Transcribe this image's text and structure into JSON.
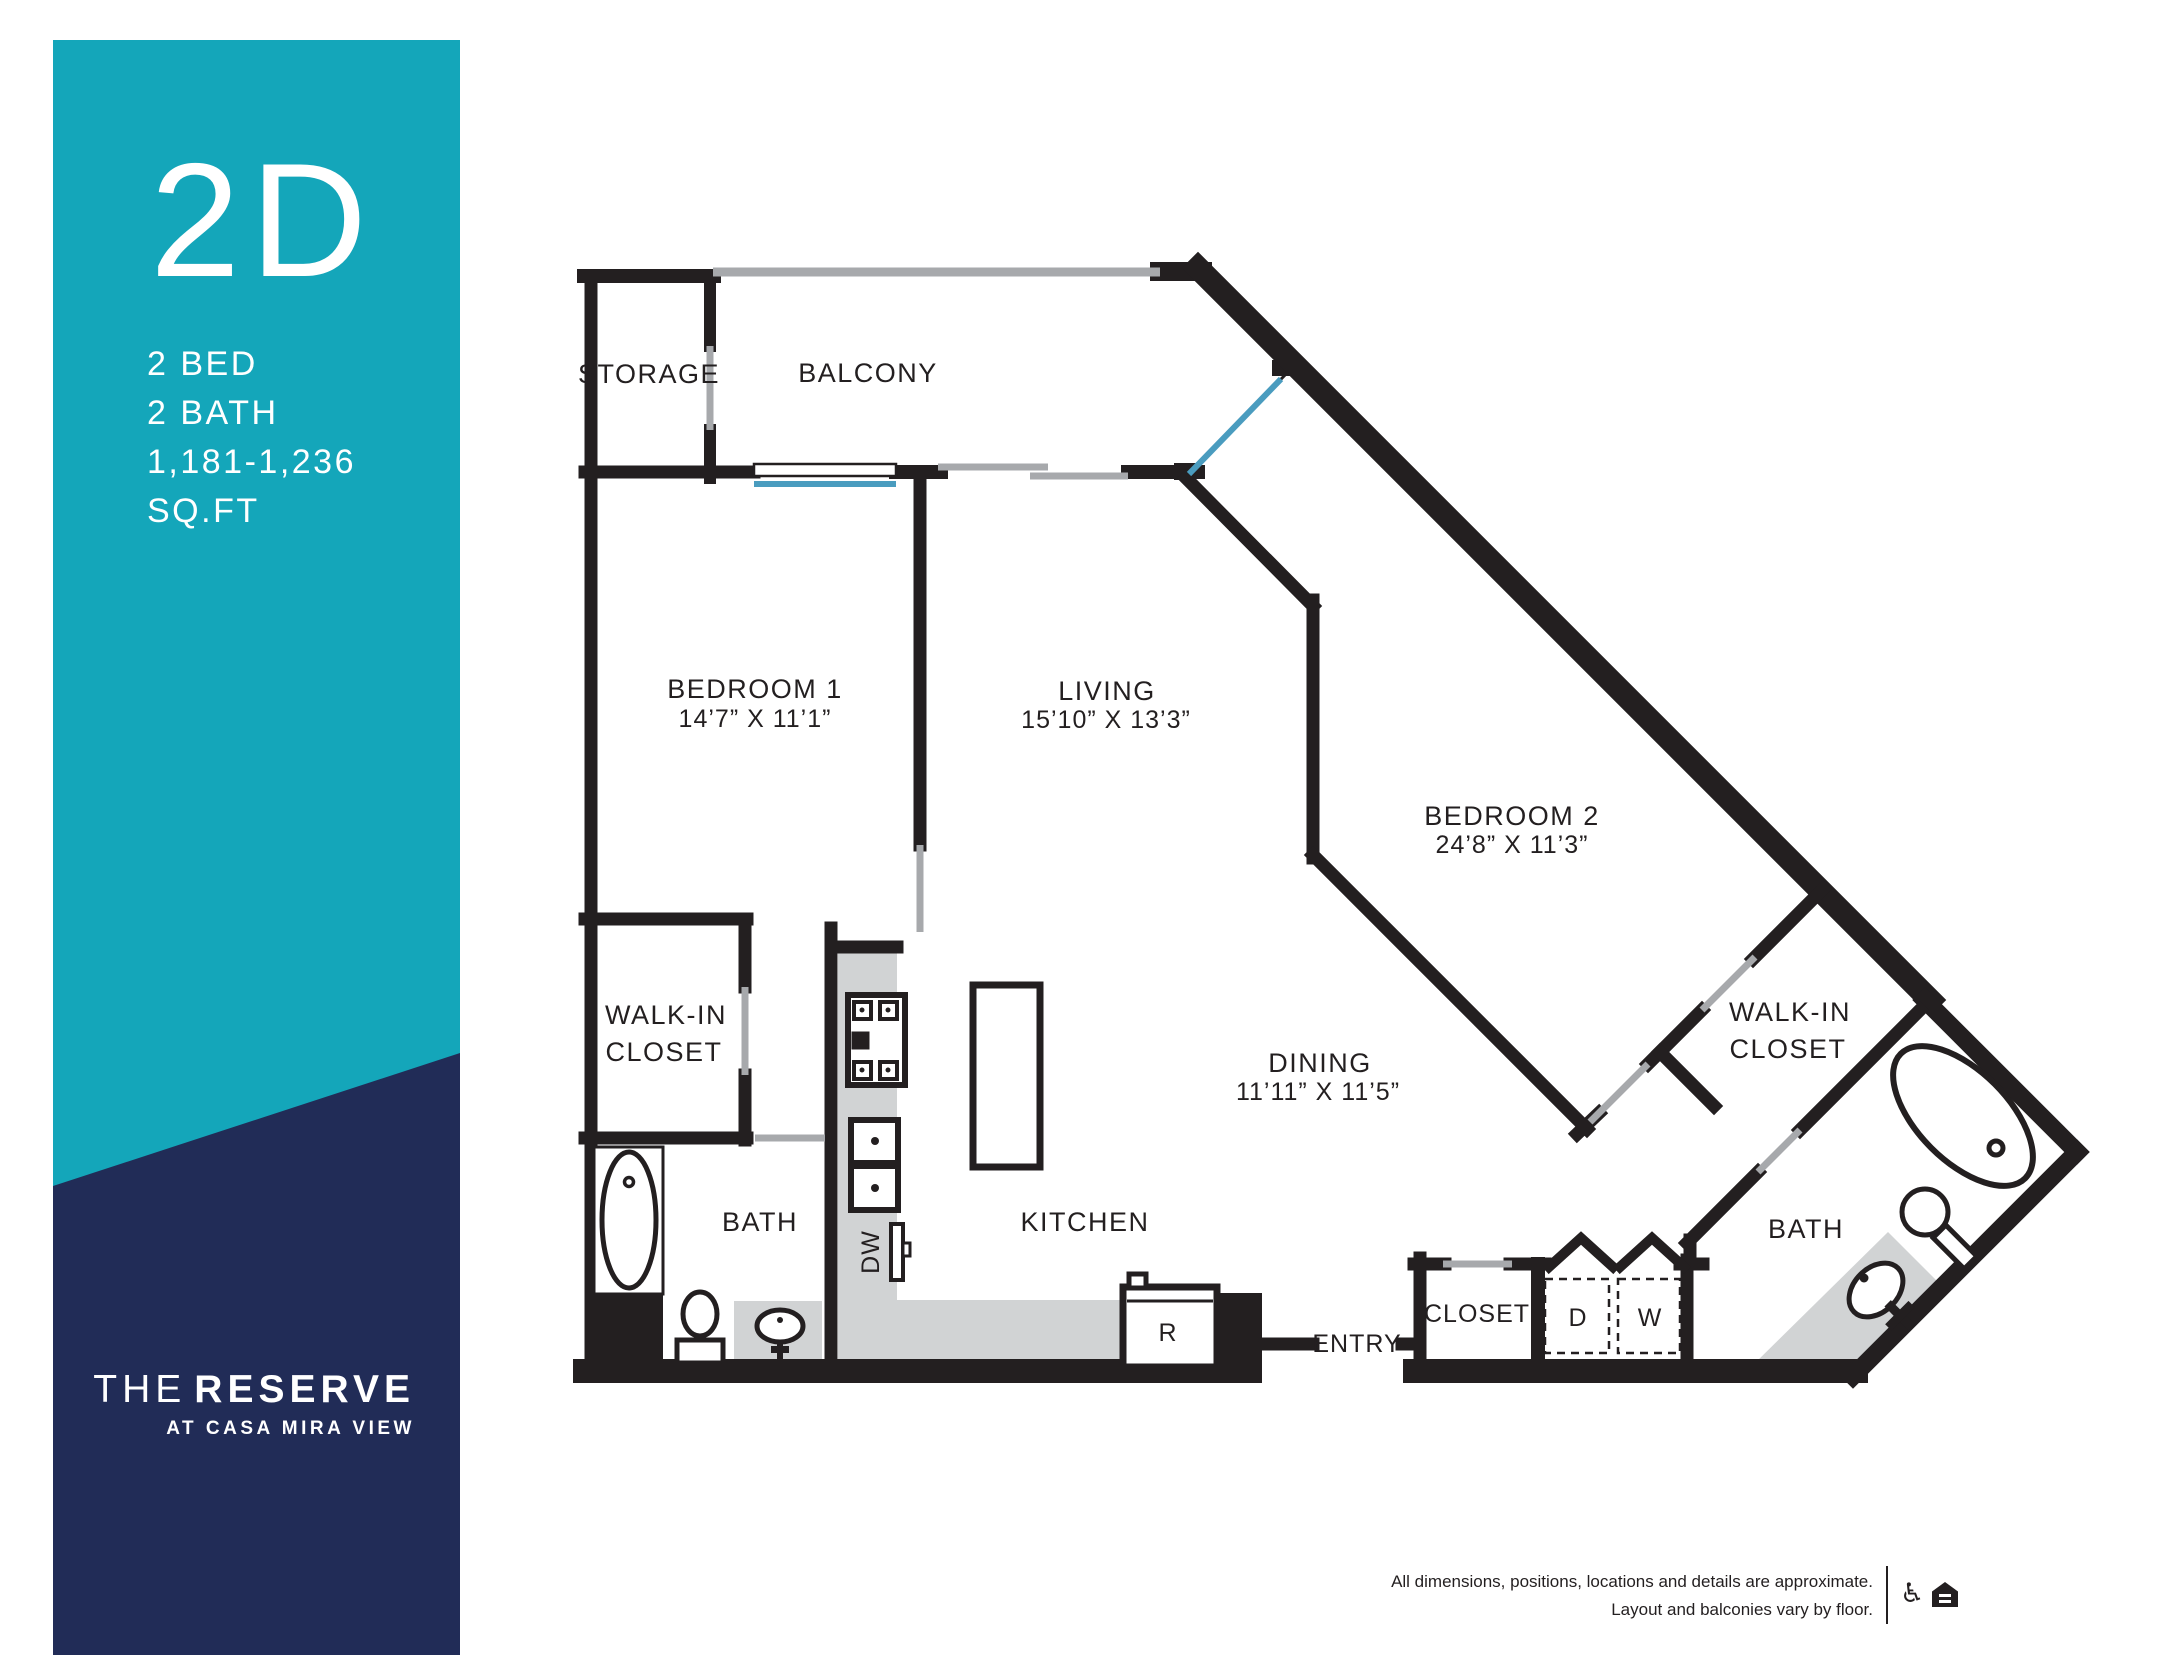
{
  "sidebar": {
    "plan_code": "2D",
    "specs": {
      "bed": "2 BED",
      "bath": "2 BATH",
      "sqft_range": "1,181-1,236",
      "sqft_label": "SQ.FT"
    },
    "brand": {
      "the": "THE",
      "reserve": "RESERVE",
      "tagline": "AT CASA MIRA VIEW"
    },
    "colors": {
      "teal": "#14a6ba",
      "navy": "#212c57",
      "text": "#ffffff"
    }
  },
  "plan": {
    "rooms": {
      "storage": {
        "label": "STORAGE"
      },
      "balcony": {
        "label": "BALCONY"
      },
      "bedroom1": {
        "label": "BEDROOM 1",
        "dims": "14’7” X 11’1”"
      },
      "living": {
        "label": "LIVING",
        "dims": "15’10” X 13’3”"
      },
      "bedroom2": {
        "label": "BEDROOM 2",
        "dims": "24’8” X 11’3”"
      },
      "dining": {
        "label": "DINING",
        "dims": "11’11” X 11’5”"
      },
      "kitchen": {
        "label": "KITCHEN"
      },
      "bath1": {
        "label": "BATH"
      },
      "bath2": {
        "label": "BATH"
      },
      "walkin1": {
        "line1": "WALK-IN",
        "line2": "CLOSET"
      },
      "walkin2": {
        "line1": "WALK-IN",
        "line2": "CLOSET"
      },
      "closet": {
        "label": "CLOSET"
      },
      "entry": {
        "label": "ENTRY"
      }
    },
    "appliances": {
      "dishwasher": "DW",
      "dryer": "D",
      "washer": "W",
      "refrigerator": "R"
    },
    "colors": {
      "wall": "#231f20",
      "door_gray": "#a7a9ac",
      "window_blue": "#4a9cbf",
      "counter_gray": "#d1d3d4"
    }
  },
  "footer": {
    "disclaimer_line1": "All dimensions, positions, locations and details are approximate.",
    "disclaimer_line2": "Layout and balconies vary by floor.",
    "wheelchair_icon_glyph": "♿"
  }
}
